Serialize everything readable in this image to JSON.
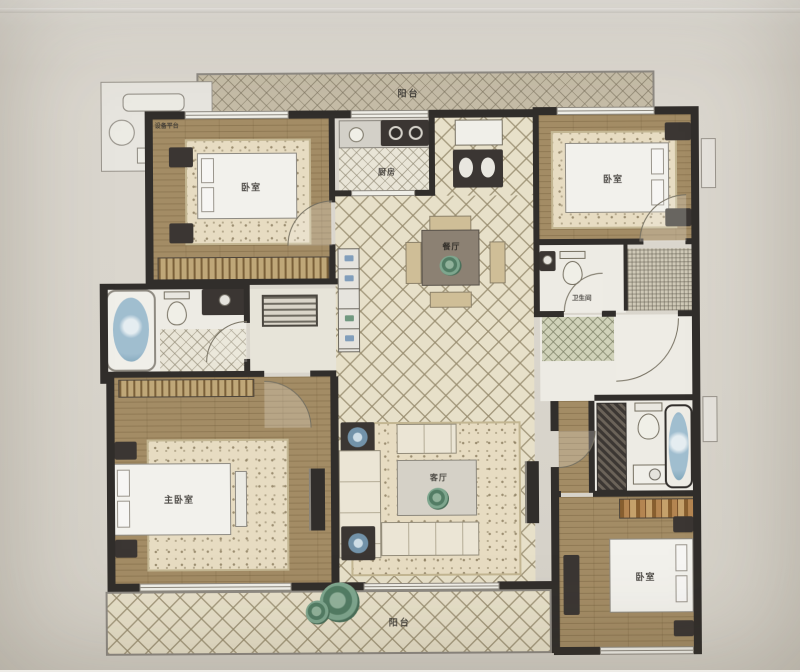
{
  "rooms": {
    "balcony_top": {
      "label": "阳台"
    },
    "equipment_platform": {
      "label": "设备平台"
    },
    "bedroom_top_left": {
      "label": "卧室"
    },
    "kitchen": {
      "label": "厨房"
    },
    "bedroom_top_right": {
      "label": "卧室"
    },
    "bathroom_right": {
      "label": "卫生间"
    },
    "dining_room": {
      "label": "餐厅"
    },
    "living_room": {
      "label": "客厅"
    },
    "master_bedroom": {
      "label": "主卧室"
    },
    "bedroom_bottom_right": {
      "label": "卧室"
    },
    "balcony_bottom": {
      "label": "阳台"
    }
  },
  "colors": {
    "wall": "#2f2b28",
    "wood_floor": "#a68c60",
    "tile_background": "#ebe3c9",
    "paper": "#d9d5cc",
    "bath_water": "#9fc0d4",
    "plant_green": "#4e7d62"
  }
}
